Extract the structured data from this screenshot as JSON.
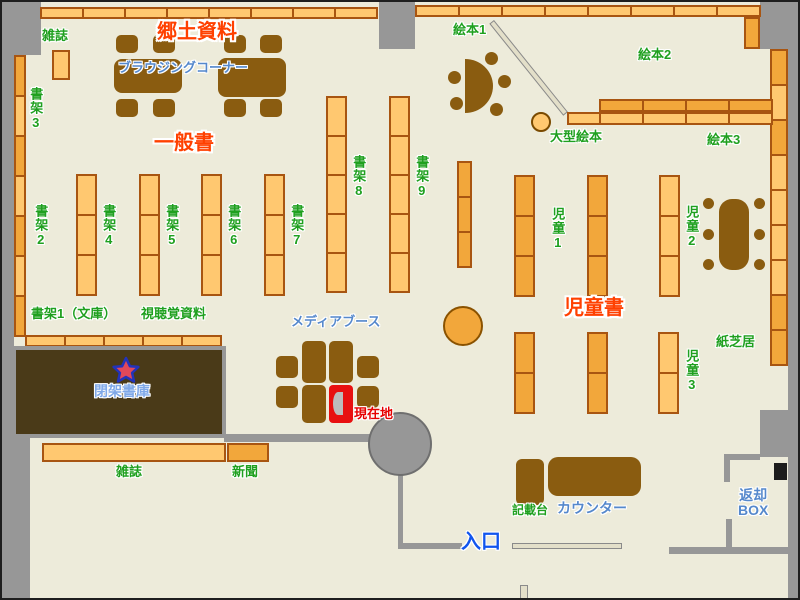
{
  "map_type": "library-floor-map",
  "colors": {
    "floor": "#EDEBDA",
    "wall": "#979797",
    "shelf_light": "#FFC870",
    "shelf_dark": "#F2A73B",
    "shelf_border": "#A85511",
    "furniture_brown": "#8A5C10",
    "closed_stacks": "#4A3A18",
    "current_red": "#E81010",
    "green_label": "#1FA01F",
    "red_label": "#FF4000",
    "blue_label": "#5588CC",
    "entrance_blue": "#1155EE",
    "star_fill": "#E0485A",
    "star_stroke": "#2233BB"
  },
  "labels": {
    "local_materials": "郷土資料",
    "magazines_top": "雑誌",
    "browsing_corner": "ブラウジングコーナー",
    "general_books": "一般書",
    "shelf3": "書架3",
    "shelf2": "書架2",
    "shelf4": "書架4",
    "shelf5": "書架5",
    "shelf6": "書架6",
    "shelf7": "書架7",
    "shelf8": "書架8",
    "shelf9": "書架9",
    "shelf1_bunko": "書架1（文庫）",
    "av_materials": "視聴覚資料",
    "picture_books1": "絵本1",
    "picture_books2": "絵本2",
    "picture_books3": "絵本3",
    "large_picture_books": "大型絵本",
    "children1": "児童1",
    "children2": "児童2",
    "children3": "児童3",
    "children_books": "児童書",
    "kamishibai": "紙芝居",
    "media_booth": "メディアブース",
    "current_location": "現在地",
    "closed_stacks": "閉架書庫",
    "magazines_bottom": "雑誌",
    "newspapers": "新聞",
    "entrance": "入口",
    "counter": "カウンター",
    "writing_desk": "記載台",
    "return_box_line1": "返却",
    "return_box_line2": "BOX"
  }
}
